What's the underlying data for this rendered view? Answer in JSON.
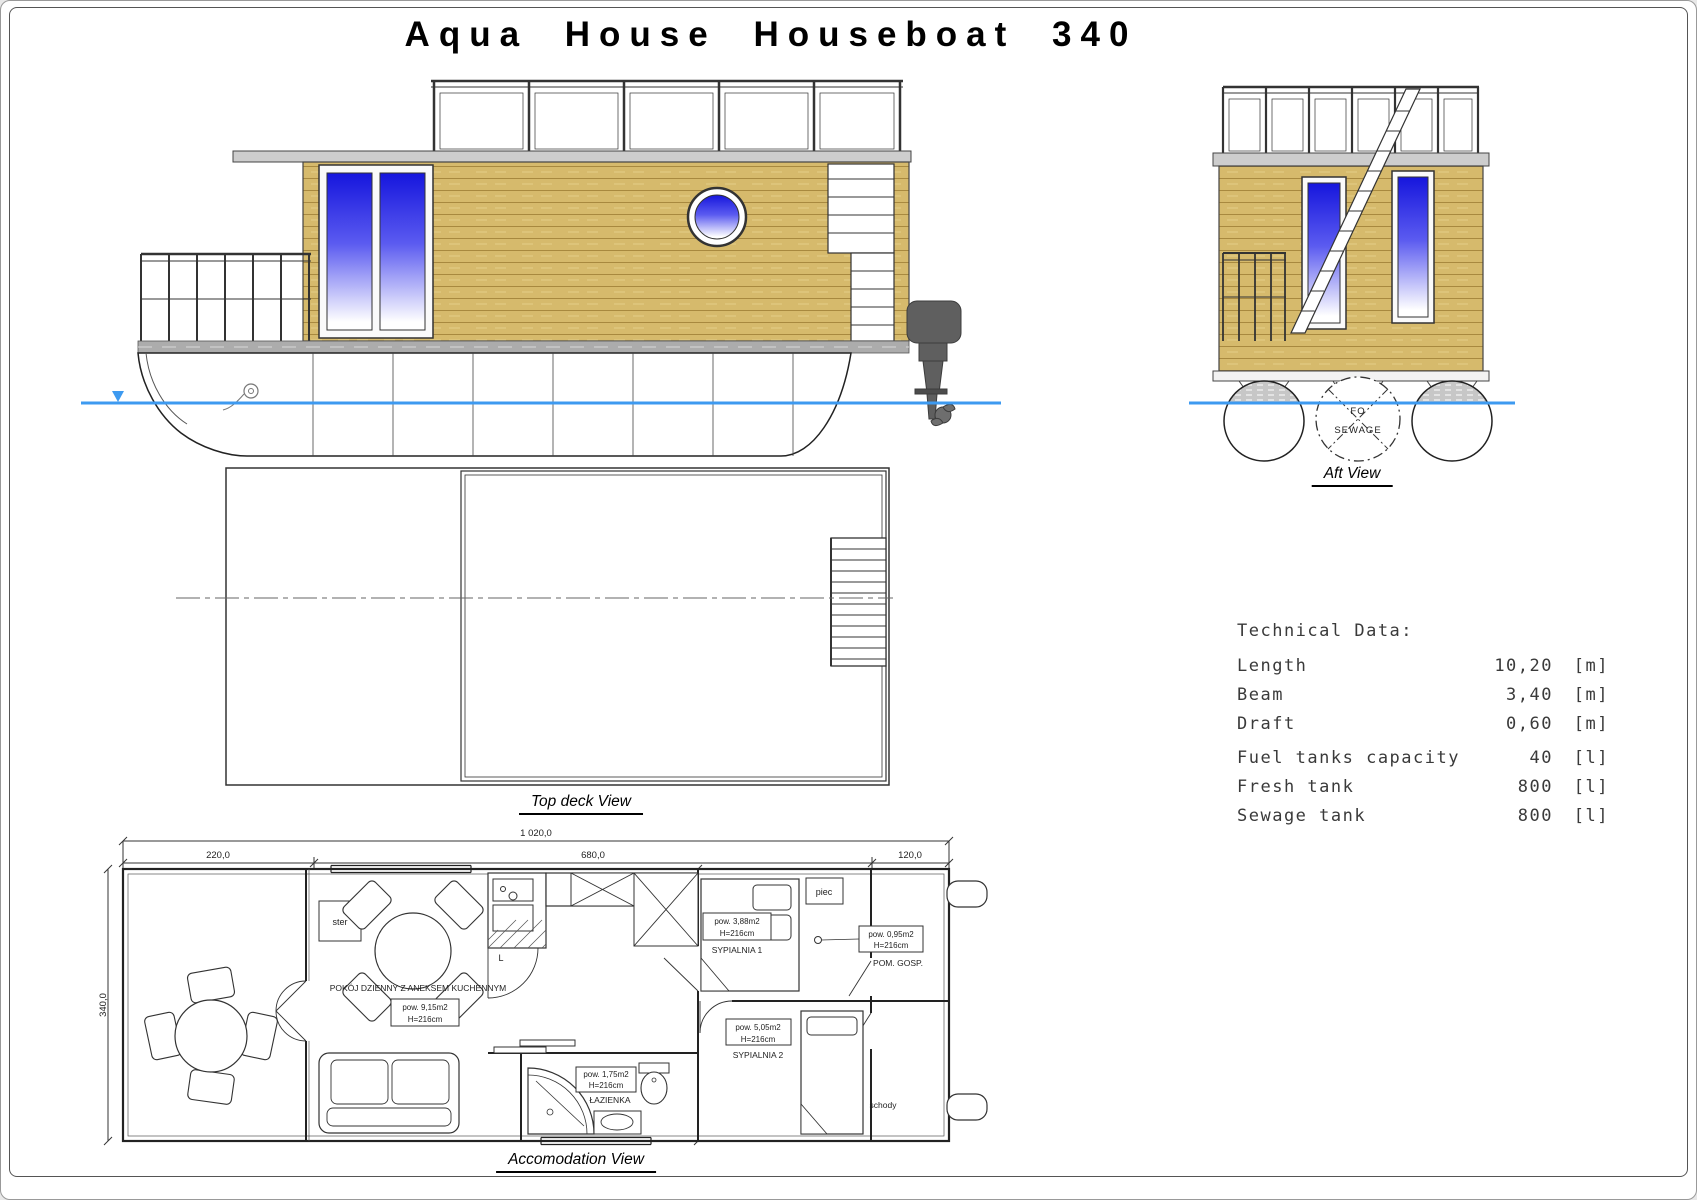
{
  "title": "Aqua House Houseboat 340",
  "views": {
    "side": {
      "label": "Side View"
    },
    "aft": {
      "label": "Aft View",
      "tank_circle": {
        "line1": "FO",
        "line2": "SEWAGE"
      }
    },
    "top_deck": {
      "label": "Top deck View"
    },
    "accommodation": {
      "label": "Accomodation View"
    }
  },
  "dimensions": {
    "overall_length": "1 020,0",
    "bow_section": "220,0",
    "cabin_section": "680,0",
    "stern_section": "120,0",
    "beam": "340,0",
    "cabin_width_1": "144,0",
    "corridor_width": "70,0",
    "aft_width": "97,0"
  },
  "rooms": {
    "helm": "ster",
    "stove": "piec",
    "stairs": "schody",
    "kitchen_letter": "L",
    "living": {
      "name": "POKÓJ DZIENNY Z ANEKSEM KUCHENNYM",
      "area": "pow. 9,15m2",
      "height": "H=216cm"
    },
    "bedroom1": {
      "name": "SYPIALNIA 1",
      "area": "pow. 3,88m2",
      "height": "H=216cm"
    },
    "bedroom2": {
      "name": "SYPIALNIA 2",
      "area": "pow. 5,05m2",
      "height": "H=216cm"
    },
    "bathroom": {
      "name": "ŁAZIENKA",
      "area": "pow. 1,75m2",
      "height": "H=216cm"
    },
    "utility": {
      "name": "POM. GOSP.",
      "area": "pow. 0,95m2",
      "height": "H=216cm"
    }
  },
  "technical_data": {
    "heading": "Technical Data:",
    "rows": [
      {
        "label": "Length",
        "value": "10,20",
        "unit": "[m]"
      },
      {
        "label": "Beam",
        "value": "3,40",
        "unit": "[m]"
      },
      {
        "label": "Draft",
        "value": "0,60",
        "unit": "[m]"
      },
      {
        "label": "Fuel tanks capacity",
        "value": "40",
        "unit": "[l]"
      },
      {
        "label": "Fresh tank",
        "value": "800",
        "unit": "[l]"
      },
      {
        "label": "Sewage tank",
        "value": "800",
        "unit": "[l]"
      }
    ]
  },
  "colors": {
    "wood": "#d6ba6c",
    "wood_line": "#a8893f",
    "window_blue": "#1616dd",
    "waterline": "#3d9af0",
    "roof_gray": "#cdcdcd",
    "deck_gray": "#acacac"
  }
}
